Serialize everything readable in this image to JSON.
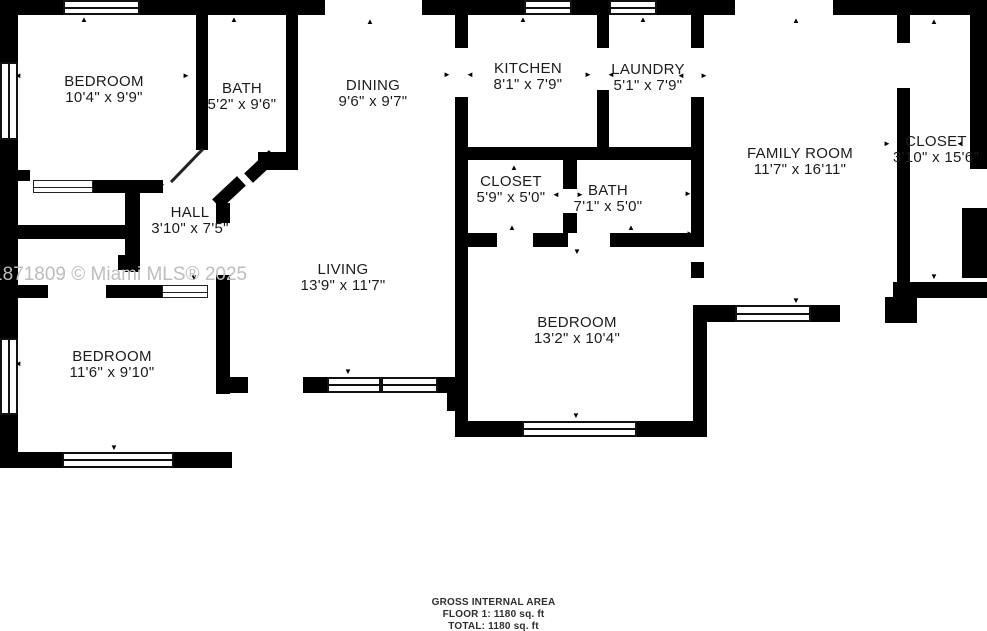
{
  "watermark": "1871809 © Miami MLS® 2025",
  "rooms": {
    "bedroom_top_left": {
      "name": "BEDROOM",
      "dims": "10'4\" x 9'9\""
    },
    "bath_top": {
      "name": "BATH",
      "dims": "5'2\" x 9'6\""
    },
    "dining": {
      "name": "DINING",
      "dims": "9'6\" x 9'7\""
    },
    "kitchen": {
      "name": "KITCHEN",
      "dims": "8'1\" x 7'9\""
    },
    "laundry": {
      "name": "LAUNDRY",
      "dims": "5'1\" x 7'9\""
    },
    "family_room": {
      "name": "FAMILY ROOM",
      "dims": "11'7\" x 16'11\""
    },
    "closet_right": {
      "name": "CLOSET",
      "dims": "3'10\" x 15'6\""
    },
    "closet_mid": {
      "name": "CLOSET",
      "dims": "5'9\" x 5'0\""
    },
    "bath_mid": {
      "name": "BATH",
      "dims": "7'1\" x 5'0\""
    },
    "hall": {
      "name": "HALL",
      "dims": "3'10\" x 7'5\""
    },
    "living": {
      "name": "LIVING",
      "dims": "13'9\" x 11'7\""
    },
    "bedroom_bottom_left": {
      "name": "BEDROOM",
      "dims": "11'6\" x 9'10\""
    },
    "bedroom_center": {
      "name": "BEDROOM",
      "dims": "13'2\" x 10'4\""
    }
  },
  "footer": {
    "line1": "GROSS INTERNAL AREA",
    "line2": "FLOOR 1: 1180 sq. ft",
    "line3": "TOTAL: 1180 sq. ft"
  },
  "icons": {
    "up": "▲",
    "down": "▼",
    "left": "◄",
    "right": "►"
  },
  "colors": {
    "wall": "#000000",
    "background": "#ffffff",
    "watermark": "#bdbdbd",
    "label_text": "#1c1c1c"
  }
}
